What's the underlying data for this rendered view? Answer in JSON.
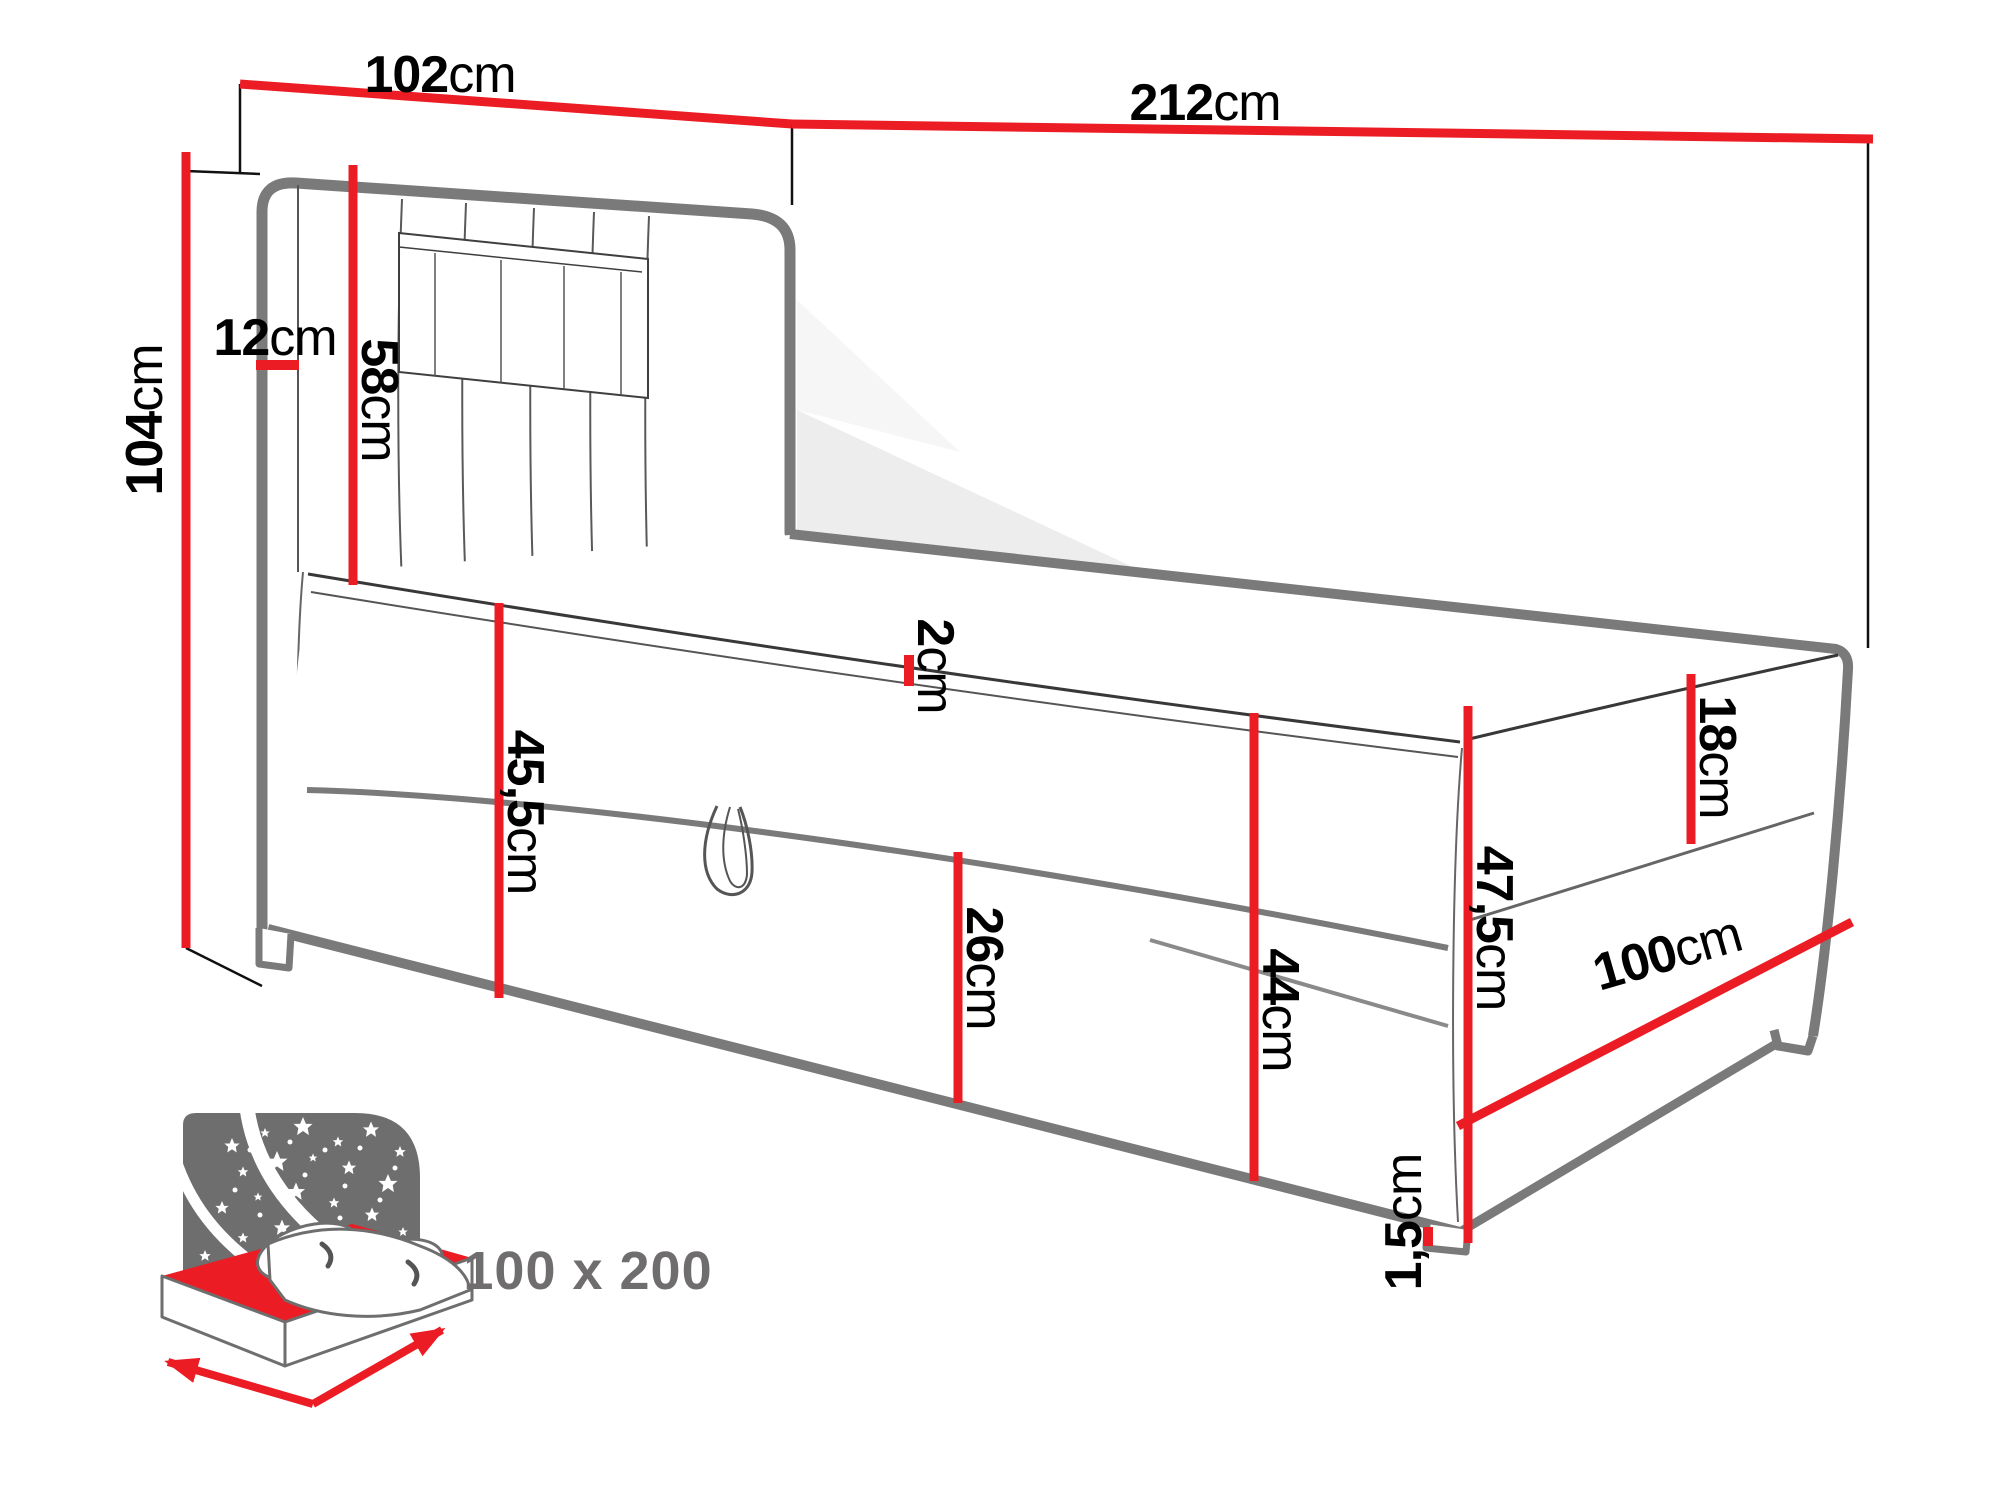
{
  "diagram": {
    "type": "bed-dimension-drawing",
    "dims": {
      "d102": {
        "value": "102",
        "unit": "cm"
      },
      "d212": {
        "value": "212",
        "unit": "cm"
      },
      "d104": {
        "value": "104",
        "unit": "cm"
      },
      "d12": {
        "value": "12",
        "unit": "cm"
      },
      "d58": {
        "value": "58",
        "unit": "cm"
      },
      "d2": {
        "value": "2",
        "unit": "cm"
      },
      "d455": {
        "value": "45,5",
        "unit": "cm"
      },
      "d26": {
        "value": "26",
        "unit": "cm"
      },
      "d44": {
        "value": "44",
        "unit": "cm"
      },
      "d18": {
        "value": "18",
        "unit": "cm"
      },
      "d475": {
        "value": "47,5",
        "unit": "cm"
      },
      "d100": {
        "value": "100",
        "unit": "cm"
      },
      "d15": {
        "value": "1,5",
        "unit": "cm"
      }
    },
    "icon": {
      "size_label": "100 x 200"
    },
    "colors": {
      "dimension_red": "#ec1c24",
      "outline_gray": "#7a7a7a",
      "thin_line": "#3f3f3f",
      "label_black": "#000000",
      "icon_gray": "#6e6e6e",
      "icon_text_gray": "#6f6d6e",
      "shadow_light": "#ededed"
    }
  }
}
